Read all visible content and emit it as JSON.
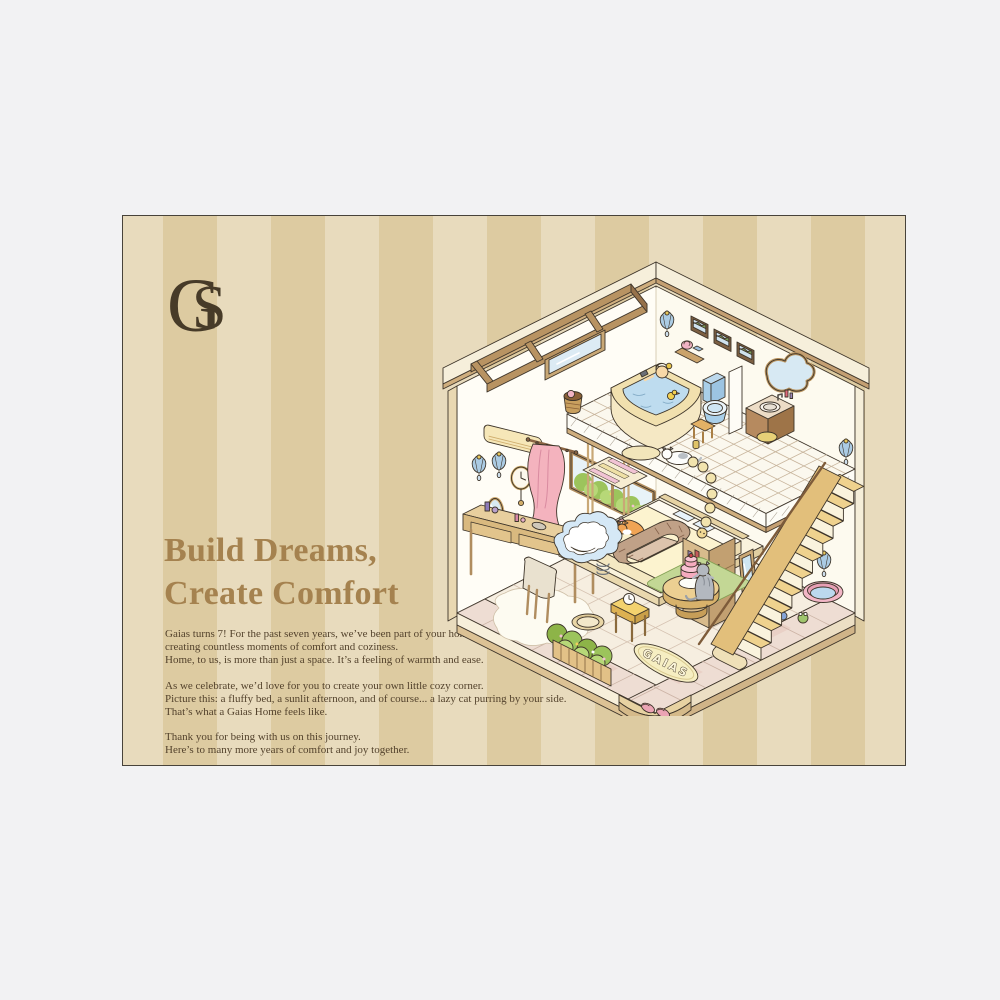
{
  "page": {
    "background": "#f2f2f3"
  },
  "card": {
    "stripe_light": "#e8dbbd",
    "stripe_dark": "#ddcba1",
    "border": "#48433a"
  },
  "logo": {
    "g": "G",
    "s": "S",
    "color": "#473b28"
  },
  "headline": {
    "lines": [
      "Build Dreams,",
      "Create Comfort"
    ],
    "color": "#a5824f"
  },
  "body": {
    "color": "#53422c",
    "paragraphs": [
      {
        "lines": [
          "Gaias turns 7! For the past seven years, we’ve been part of your home,",
          "creating countless moments of comfort and coziness.",
          "Home, to us, is more than just a space. It’s a feeling of warmth and ease."
        ]
      },
      {
        "lines": [
          "As we celebrate, we’d love for you to create your own little cozy corner.",
          "Picture this: a fluffy bed, a sunlit afternoon, and of course... a lazy cat purring by your side.",
          "That’s what a Gaias Home feels like."
        ]
      },
      {
        "lines": [
          "Thank you for being with us on this journey.",
          "Here’s to many more years of comfort and joy together."
        ]
      }
    ]
  },
  "illustration": {
    "rug_text": "GAIAS",
    "palette": {
      "wall": "#fffdf6",
      "roof_cream": "#f6efdb",
      "wood": "#b89362",
      "wood_dark": "#6f5233",
      "tile_grout": "#c7b49b",
      "floor": "#f3eadb",
      "walkway_pink": "#eeddd3",
      "water_blue": "#bedcef",
      "curtain_pink": "#f4b3be",
      "hedge_green": "#9cc45c",
      "stair_tread": "#efd28e",
      "accent_pink": "#f2b6c6",
      "accent_blue": "#a9cfe9",
      "outline": "#3e352a"
    },
    "elements": [
      "isometric dollhouse cutaway",
      "bathroom loft with corner bathtub",
      "person bathing with rubber duck",
      "blue toilet",
      "wash basin vanity",
      "wavy wall mirror",
      "three framed pictures",
      "shell wall sconces",
      "striped bath mat",
      "wicker basket",
      "white cat on tiled loft floor",
      "caterpillar plush",
      "air conditioner",
      "pendulum wall clock",
      "oval wall mirror",
      "pink curtain",
      "garden window with hedge",
      "bed with sleeping orange cat",
      "knitted pet sofa",
      "cloud bean bag",
      "vanity desk with cosmetics",
      "chair on fluffy rug",
      "round table with birthday cake",
      "grey cat reaching for cake",
      "wooden staircase with handrail",
      "pink pet bed",
      "frog toy",
      "hedge planter with picket fence",
      "GAIAS rug",
      "entrance step with pink slippers"
    ]
  }
}
